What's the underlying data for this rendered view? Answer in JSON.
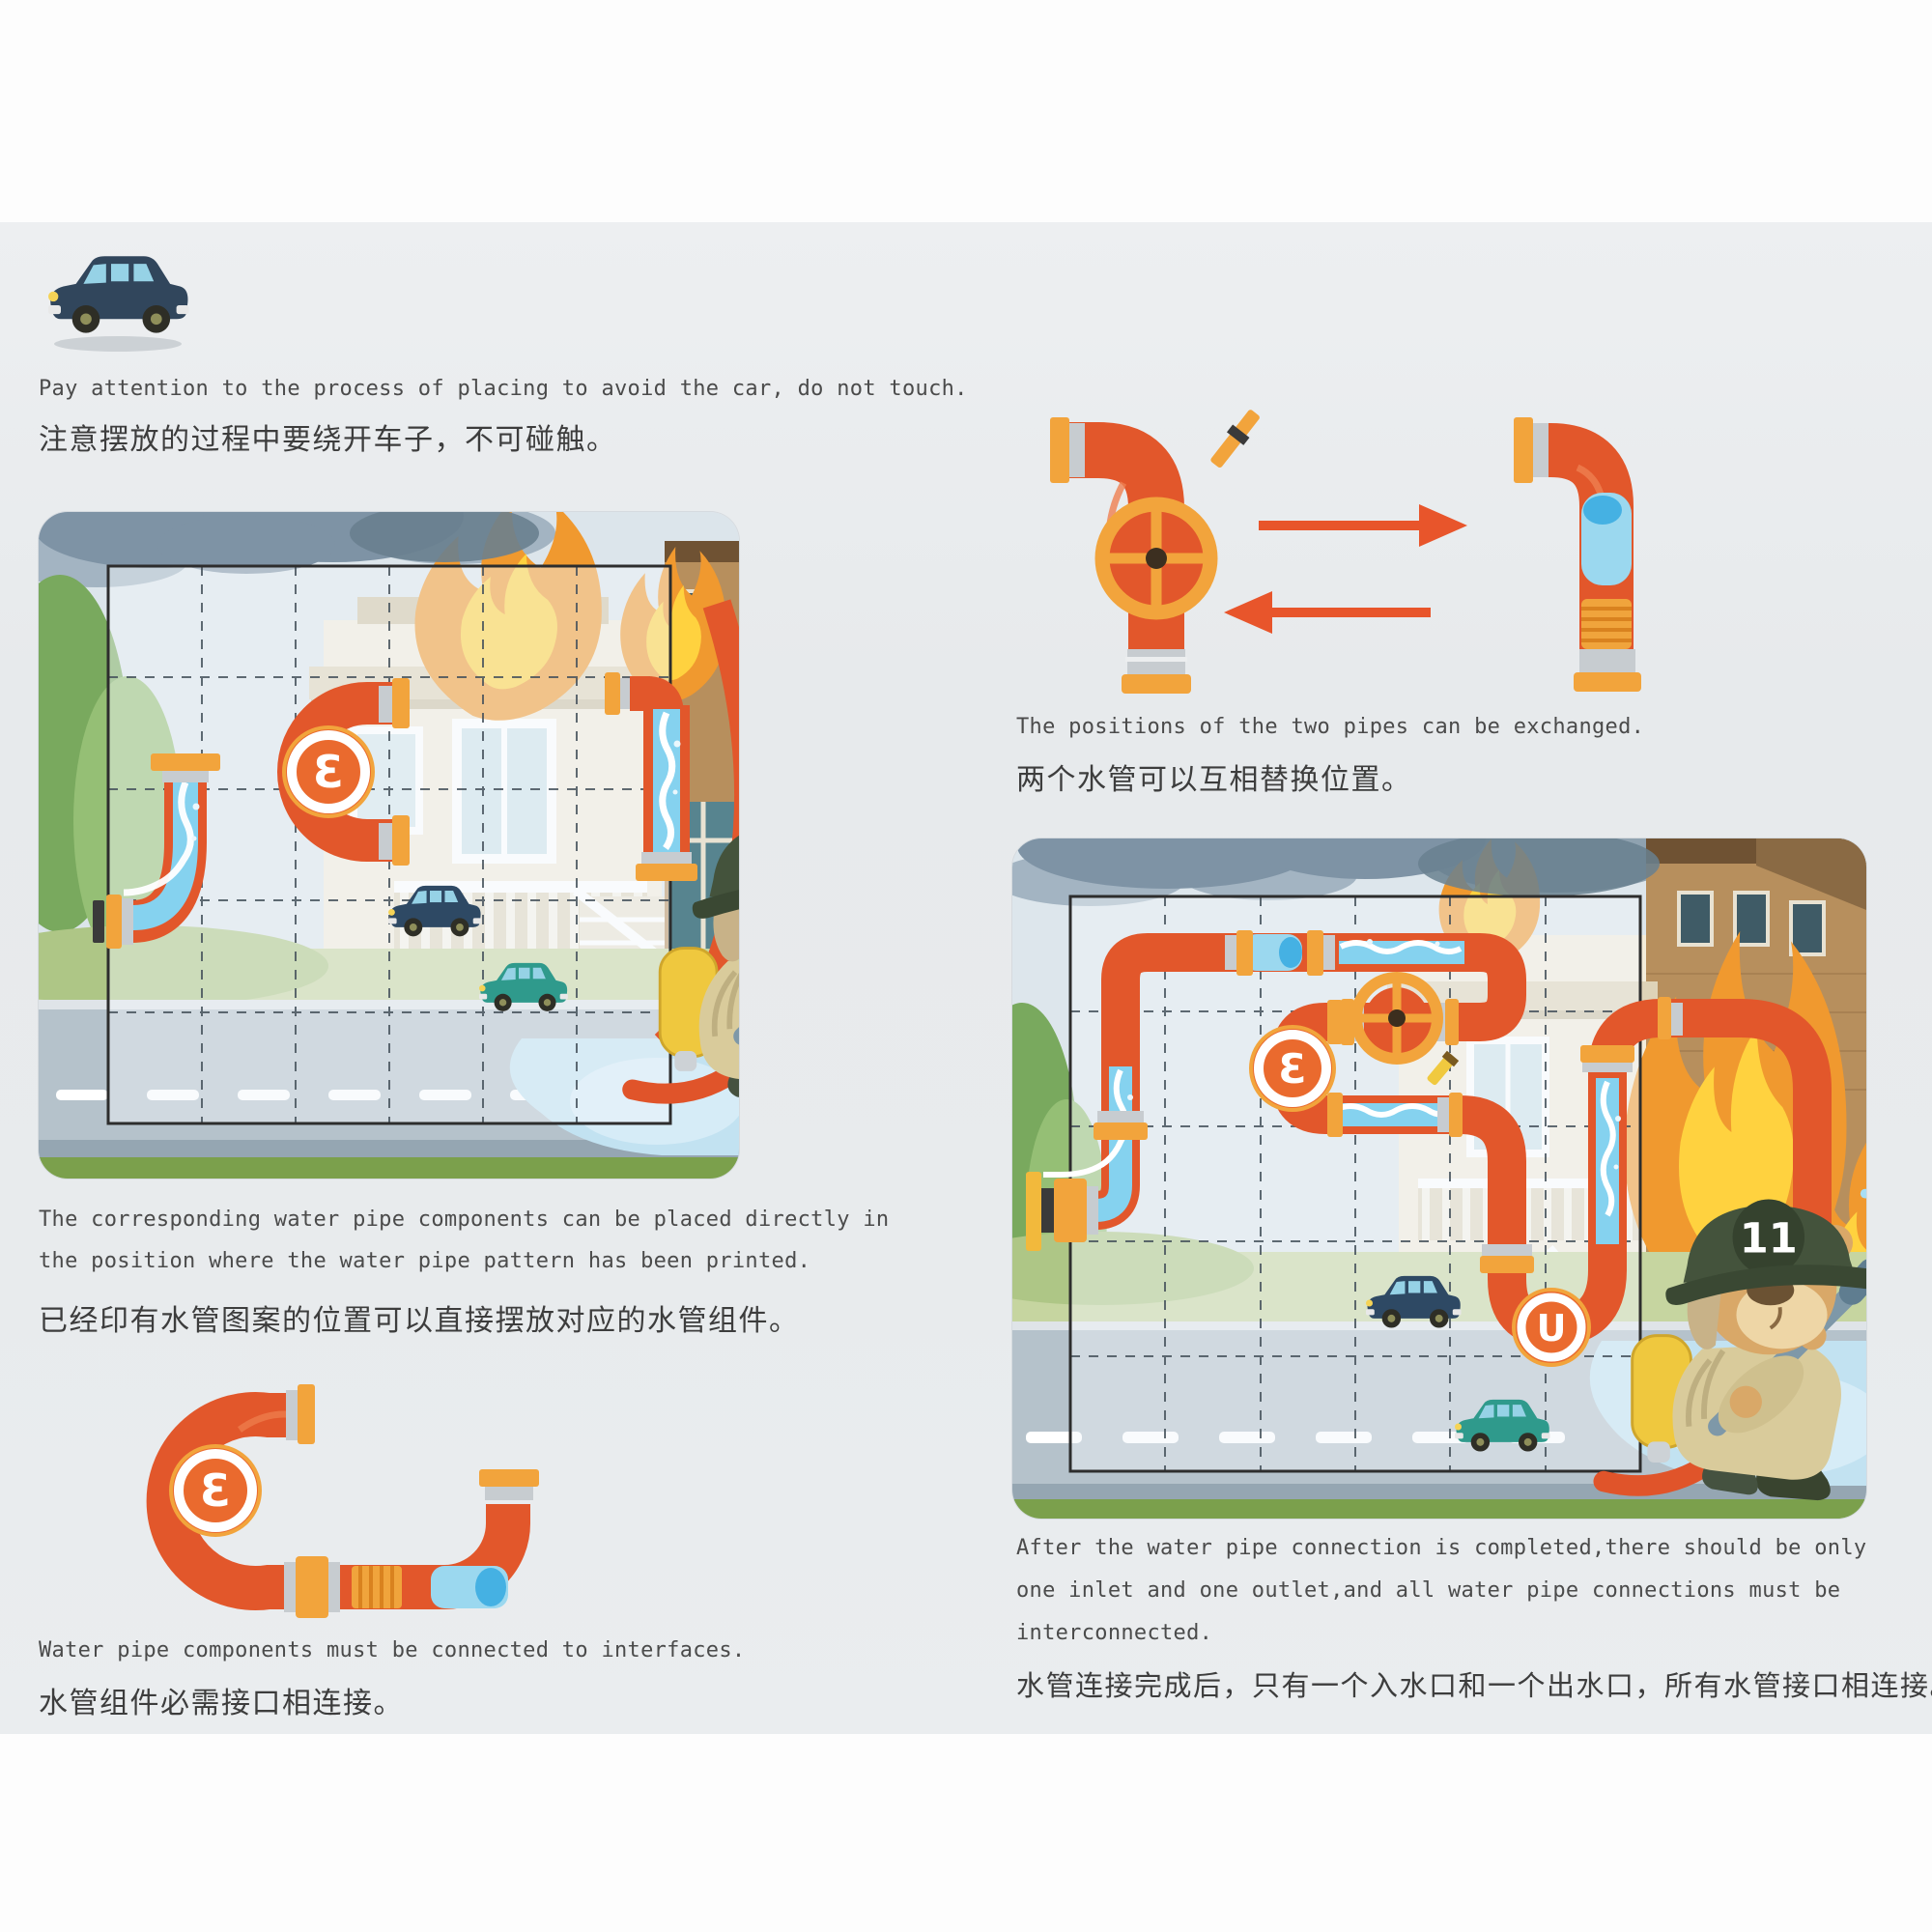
{
  "texts": {
    "avoid_car": {
      "en": "Pay attention to the process of placing to avoid the car, do not touch.",
      "cn": "注意摆放的过程中要绕开车子，不可碰触。"
    },
    "exchange": {
      "en": "The positions of the two pipes can be exchanged.",
      "cn": "两个水管可以互相替换位置。"
    },
    "printed": {
      "en_lines": [
        "The corresponding water pipe components can be placed directly in",
        "the position where the water pipe pattern has been printed."
      ],
      "cn": "已经印有水管图案的位置可以直接摆放对应的水管组件。"
    },
    "interfaces": {
      "en": "Water pipe components must be connected to interfaces.",
      "cn": "水管组件必需接口相连接。"
    },
    "completed": {
      "en_lines": [
        "After the water pipe connection is completed,there should be only",
        "one inlet and one outlet,and all water pipe connections must be",
        "interconnected."
      ],
      "cn": "水管连接完成后，只有一个入水口和一个出水口，所有水管接口相连接。"
    }
  },
  "board": {
    "helmet_number": "11",
    "gauge_letter": "Ɛ",
    "outlet_letter": "U"
  },
  "colors": {
    "pipe_orange": "#e2572b",
    "flange_orange": "#f2a43c",
    "water_blue": "#85d2ef",
    "arrow_orange": "#e8552b",
    "page_gray": "#e8ebed",
    "fire_orange": "#f0992f",
    "fire_yellow": "#ffd23f"
  }
}
